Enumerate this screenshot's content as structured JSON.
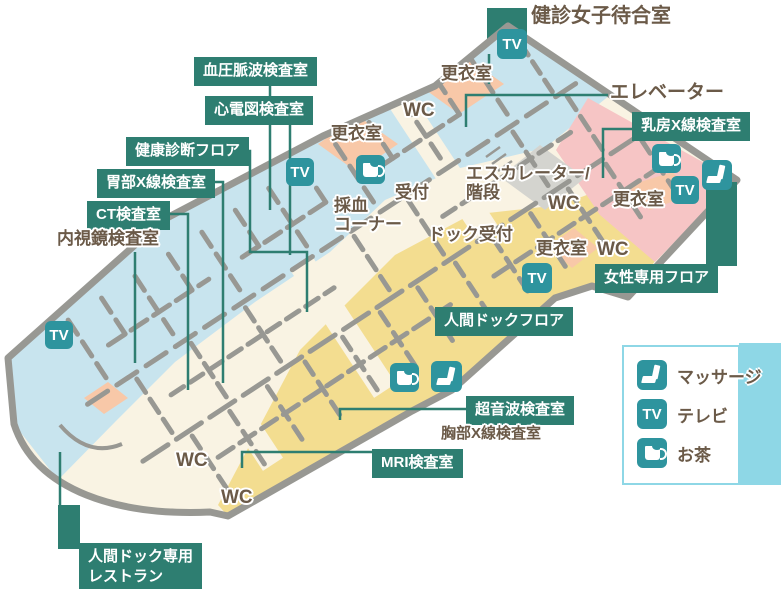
{
  "colors": {
    "label_teal": "#2E7E71",
    "icon_teal": "#2E949E",
    "text_brown": "#6B5A48",
    "floor_blue": "#C8E4EE",
    "floor_yellow": "#F3DD90",
    "floor_pink": "#F6C5C5",
    "room_salmon": "#F8C8A8",
    "corridor_cream": "#F9F3E3",
    "wall_gray": "#989893",
    "legend_blue": "#8ED7E6"
  },
  "map": {
    "icon_tv_text": "TV",
    "floor_labels": [
      {
        "label": "血圧脈波検査室",
        "x": 194,
        "y": 57
      },
      {
        "label": "心電図検査室",
        "x": 205,
        "y": 96
      },
      {
        "label": "健康診断フロア",
        "x": 126,
        "y": 137
      },
      {
        "label": "胃部X線検査室",
        "x": 97,
        "y": 169
      },
      {
        "label": "CT検査室",
        "x": 87,
        "y": 201
      },
      {
        "label": "乳房X線検査室",
        "x": 632,
        "y": 112
      },
      {
        "label": "女性専用フロア",
        "x": 595,
        "y": 264
      },
      {
        "label": "人間ドックフロア",
        "x": 435,
        "y": 307
      },
      {
        "label": "超音波検査室",
        "x": 466,
        "y": 396
      },
      {
        "label": "MRI検査室",
        "x": 372,
        "y": 449
      },
      {
        "label": "人間ドック専用\nレストラン",
        "x": 79,
        "y": 543
      }
    ],
    "room_texts": [
      {
        "label": "健診女子待合室",
        "x": 531,
        "y": 5,
        "size": 20
      },
      {
        "label": "エレベーター",
        "x": 610,
        "y": 82,
        "size": 19
      },
      {
        "label": "更衣室",
        "x": 441,
        "y": 64,
        "size": 17
      },
      {
        "label": "WC",
        "x": 403,
        "y": 100,
        "size": 19
      },
      {
        "label": "更衣室",
        "x": 331,
        "y": 124,
        "size": 17
      },
      {
        "label": "採血\nコーナー",
        "x": 334,
        "y": 196,
        "size": 17
      },
      {
        "label": "受付",
        "x": 395,
        "y": 183,
        "size": 17
      },
      {
        "label": "エスカレーター/\n階段",
        "x": 466,
        "y": 164,
        "size": 17
      },
      {
        "label": "ドック受付",
        "x": 428,
        "y": 225,
        "size": 17
      },
      {
        "label": "WC",
        "x": 548,
        "y": 193,
        "size": 19
      },
      {
        "label": "更衣室",
        "x": 613,
        "y": 190,
        "size": 17
      },
      {
        "label": "更衣室",
        "x": 536,
        "y": 239,
        "size": 17
      },
      {
        "label": "WC",
        "x": 597,
        "y": 239,
        "size": 19
      },
      {
        "label": "内視鏡検査室",
        "x": 57,
        "y": 229,
        "size": 17
      },
      {
        "label": "胸部X線検査室",
        "x": 441,
        "y": 426,
        "size": 15
      },
      {
        "label": "WC",
        "x": 176,
        "y": 450,
        "size": 19
      },
      {
        "label": "WC",
        "x": 221,
        "y": 487,
        "size": 19
      }
    ],
    "icons": [
      {
        "type": "tv",
        "x": 497,
        "y": 29,
        "size": 30
      },
      {
        "type": "tv",
        "x": 286,
        "y": 158,
        "size": 28
      },
      {
        "type": "tv",
        "x": 45,
        "y": 321,
        "size": 28
      },
      {
        "type": "tv",
        "x": 522,
        "y": 263,
        "size": 30
      },
      {
        "type": "tv",
        "x": 671,
        "y": 176,
        "size": 28
      },
      {
        "type": "tea",
        "x": 356,
        "y": 155,
        "size": 29
      },
      {
        "type": "tea",
        "x": 652,
        "y": 144,
        "size": 29
      },
      {
        "type": "tea",
        "x": 390,
        "y": 363,
        "size": 29
      },
      {
        "type": "massage",
        "x": 431,
        "y": 361,
        "size": 31
      },
      {
        "type": "massage",
        "x": 702,
        "y": 160,
        "size": 30
      }
    ]
  },
  "legend": {
    "items": [
      {
        "icon": "massage",
        "label": "マッサージ"
      },
      {
        "icon": "tv",
        "label": "テレビ"
      },
      {
        "icon": "tea",
        "label": "お茶"
      }
    ]
  }
}
